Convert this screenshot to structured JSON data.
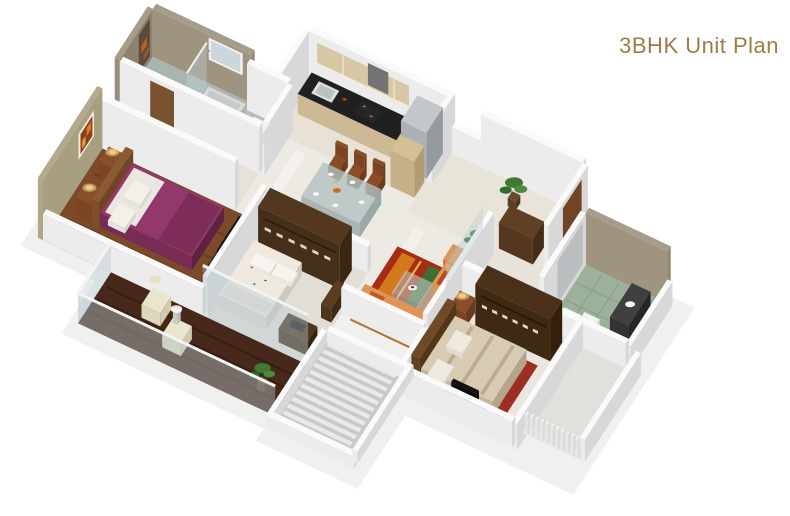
{
  "title": "3BHK Unit Plan",
  "title_color": "#9e7c49",
  "background": "#ffffff",
  "plan": {
    "type": "3d-isometric-floor-plan-render",
    "unit_type": "3BHK",
    "rooms": [
      {
        "name": "attached-bathroom",
        "features": [
          "shower-enclosure",
          "glass-partition",
          "washbasin",
          "toilet",
          "mirror",
          "mosaic-accent-wall"
        ],
        "floor_color": "#aab5b0",
        "wall_color": "#a79c8a"
      },
      {
        "name": "common-toilet",
        "features": [
          "toilet"
        ],
        "floor_color": "#b6bfb9"
      },
      {
        "name": "bedroom-1",
        "features": [
          "double-bed-purple",
          "headboard",
          "bedside-tables",
          "table-lamps",
          "wall-art",
          "tv-unit"
        ],
        "floor_color": "#7c4a28",
        "accent_wall_color": "#b3aa8e",
        "bed_color": "#93386b"
      },
      {
        "name": "kitchen",
        "features": [
          "black-countertop",
          "sink",
          "hob",
          "chimney",
          "overhead-cabinets",
          "refrigerator",
          "tall-cabinet"
        ],
        "cabinet_color": "#d8c7a6",
        "counter_color": "#202020"
      },
      {
        "name": "dining-area",
        "features": [
          "glass-dining-table",
          "six-wooden-chairs",
          "dinner-plates",
          "serving-dish"
        ],
        "chair_color": "#8a4d28"
      },
      {
        "name": "entrance-foyer",
        "features": [
          "potted-plant",
          "shoe-cabinet",
          "main-door"
        ]
      },
      {
        "name": "living-room",
        "features": [
          "orange-l-sofa",
          "ottoman",
          "patterned-rug",
          "glass-coffee-table",
          "potted-plant",
          "glass-partition"
        ],
        "sofa_color": "#e09555",
        "rug_color": "#a82c14"
      },
      {
        "name": "bedroom-2",
        "features": [
          "single-bed-floral",
          "wardrobe-with-hangers",
          "study-desk",
          "glass-wall-to-balcony"
        ],
        "wardrobe_color": "#53381f"
      },
      {
        "name": "balcony",
        "features": [
          "dark-wood-deck",
          "two-lounge-chairs",
          "round-table",
          "potted-plant",
          "glass-railing"
        ],
        "deck_color": "#46291a"
      },
      {
        "name": "master-bedroom",
        "features": [
          "double-bed-beige",
          "red-rug",
          "wardrobe-with-hangers",
          "tv-unit",
          "bedside-lamps"
        ],
        "rug_color": "#9c2f23"
      },
      {
        "name": "bathroom-2",
        "features": [
          "green-tile-floor",
          "dark-vanity-washbasin",
          "toilet",
          "shower-glass"
        ],
        "floor_color": "#9cb19b"
      },
      {
        "name": "louvered-pergola",
        "features": [
          "horizontal-roof-slats"
        ]
      },
      {
        "name": "utility-louvers",
        "features": [
          "vertical-louver-fence"
        ]
      }
    ]
  }
}
